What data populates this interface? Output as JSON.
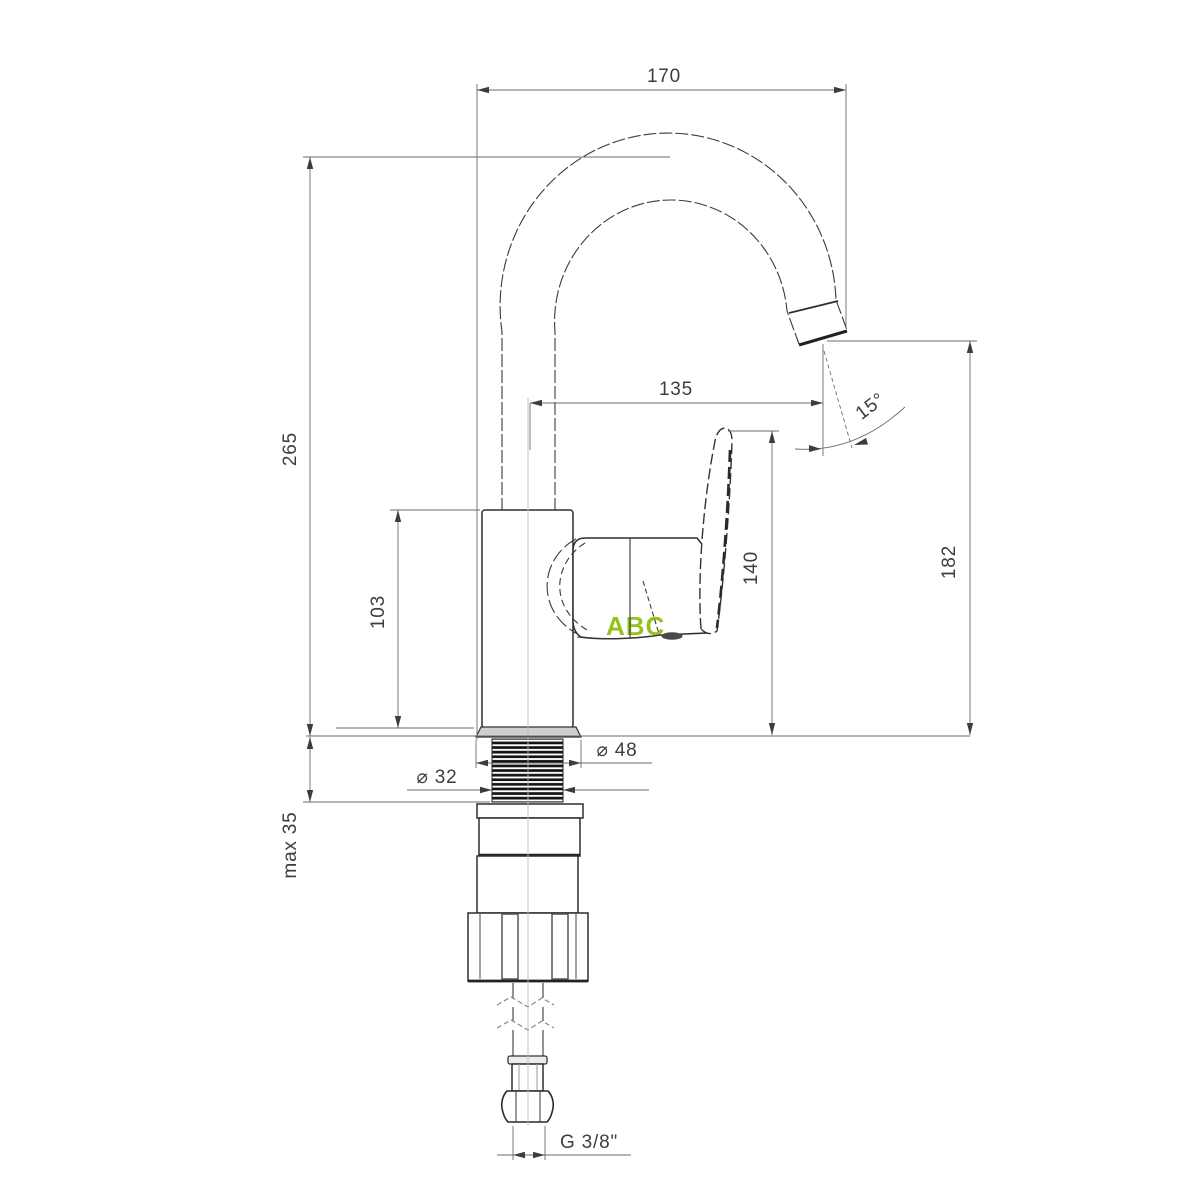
{
  "drawing": {
    "type": "faucet-technical-dimension-drawing",
    "watermark": {
      "text": "ABC",
      "color": "#95c11f"
    },
    "line_color": "#2f2f2f",
    "dim_color": "#3d3d3d",
    "dims": {
      "spout_span": "170",
      "overall_height": "265",
      "spout_reach": "135",
      "aerator_angle": "15°",
      "body_height": "103",
      "lever_height": "140",
      "outlet_height": "182",
      "escutcheon_diameter": "⌀ 48",
      "shank_diameter": "⌀ 32",
      "max_counter_thickness": "max 35",
      "hose_thread": "G 3/8\""
    }
  }
}
